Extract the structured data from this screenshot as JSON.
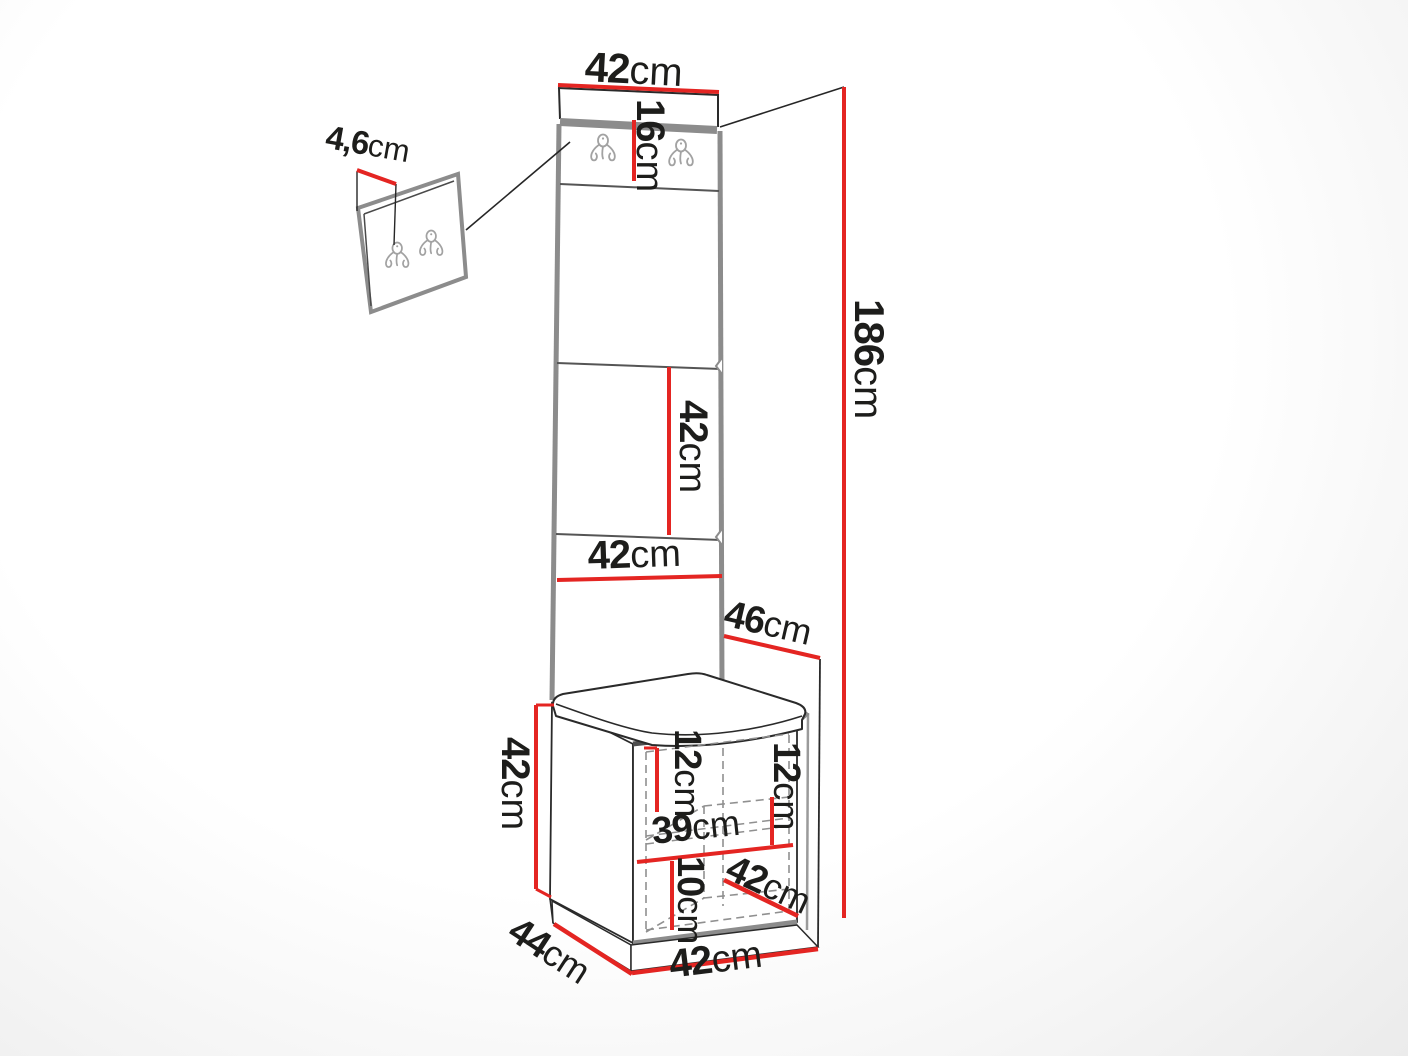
{
  "diagram": {
    "type": "furniture-dimension-diagram",
    "subject": "hallway set: wall hook panel, upholstered panel column, bench cabinet",
    "accent_color": "#e42522",
    "outline_color": "#2a2a2a",
    "edge_color": "#8c8c8c",
    "labels": {
      "panel_top_width": {
        "value": "42",
        "unit": "cm"
      },
      "hook_strip_height": {
        "value": "16",
        "unit": "cm"
      },
      "hook_plate_thickness": {
        "value": "4,6",
        "unit": "cm"
      },
      "total_height": {
        "value": "186",
        "unit": "cm"
      },
      "panel_segment_height": {
        "value": "42",
        "unit": "cm"
      },
      "panel_mid_width": {
        "value": "42",
        "unit": "cm"
      },
      "seat_depth_top": {
        "value": "46",
        "unit": "cm"
      },
      "bench_height": {
        "value": "42",
        "unit": "cm"
      },
      "inner_left_height": {
        "value": "12",
        "unit": "cm"
      },
      "inner_right_height": {
        "value": "12",
        "unit": "cm"
      },
      "shelf_width": {
        "value": "39",
        "unit": "cm"
      },
      "bottom_shelf_height": {
        "value": "10",
        "unit": "cm"
      },
      "inner_depth": {
        "value": "42",
        "unit": "cm"
      },
      "base_depth": {
        "value": "44",
        "unit": "cm"
      },
      "base_width": {
        "value": "42",
        "unit": "cm"
      }
    }
  }
}
